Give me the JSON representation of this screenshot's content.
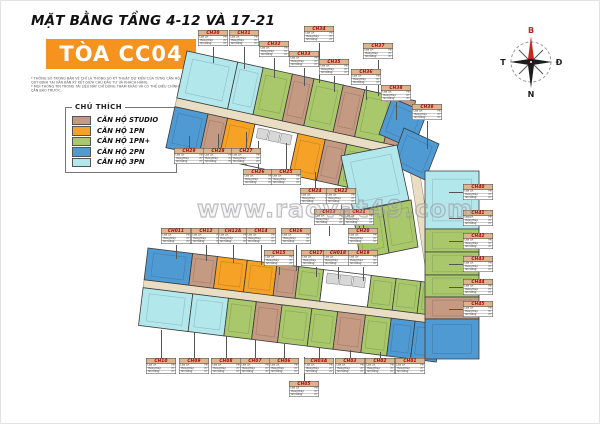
{
  "header": {
    "title": "MẶT BẰNG TẦNG 4-12 VÀ 17-21",
    "tower": "TÒA CC04",
    "disclaimer1": "* THÔNG SỐ TRONG BẢN VẼ CHỈ LÀ THÔNG SỐ KỸ THUẬT DỰ KIẾN CỦA TỪNG CĂN HỘ, SẼ ĐƯỢC QUY ĐỊNH TẠI VĂN BẢN KÝ KẾT GIỮA CHỦ ĐẦU TƯ VÀ KHÁCH HÀNG.",
    "disclaimer2": "* MỌI THÔNG TIN TRONG TÀI LIỆU NÀY CHỈ DÙNG THAM KHẢO VÀ CÓ THỂ ĐIỀU CHỈNH MÀ KHÔNG CẦN BÁO TRƯỚC."
  },
  "legend": {
    "title": "CHÚ THÍCH",
    "items": [
      {
        "label": "CĂN HỘ STUDIO",
        "type": "studio"
      },
      {
        "label": "CĂN HỘ 1PN",
        "type": "1pn"
      },
      {
        "label": "CĂN HỘ 1PN+",
        "type": "1pn+"
      },
      {
        "label": "CĂN HỘ 2PN",
        "type": "2pn"
      },
      {
        "label": "CĂN HỘ 3PN",
        "type": "3pn"
      }
    ]
  },
  "compass": {
    "north": "B",
    "south": "N",
    "east": "Đ",
    "west": "T"
  },
  "watermark": {
    "text": "www.raovat49.com"
  },
  "callout_rows": [
    {
      "k": "Loại CH:",
      "v": "PN"
    },
    {
      "k": "Thông thủy:",
      "v": "m²"
    },
    {
      "k": "Tim tường:",
      "v": "m²"
    }
  ],
  "colors": {
    "studio": "#c49a83",
    "1pn": "#f5a226",
    "1pn+": "#a9c86b",
    "2pn": "#4f9ad3",
    "3pn": "#b2e7ec",
    "corridor": "#e9dec4",
    "core": "#ffffff",
    "accent_orange": "#f6921e",
    "label_header": "#dcb48e",
    "unit_code_red": "#b40000"
  },
  "units": [
    {
      "id": "CH30",
      "type": "3pn"
    },
    {
      "id": "CH31",
      "type": "3pn"
    },
    {
      "id": "CH32",
      "type": "1pn+"
    },
    {
      "id": "CH33",
      "type": "studio"
    },
    {
      "id": "CH34",
      "type": "1pn+"
    },
    {
      "id": "CH35",
      "type": "studio"
    },
    {
      "id": "CH36",
      "type": "1pn+"
    },
    {
      "id": "CH37",
      "type": "studio"
    },
    {
      "id": "CH38",
      "type": "2pn"
    },
    {
      "id": "CH39",
      "type": "2pn"
    },
    {
      "id": "CH29",
      "type": "2pn"
    },
    {
      "id": "CH28",
      "type": "studio"
    },
    {
      "id": "CH27",
      "type": "1pn"
    },
    {
      "id": "CH26",
      "type": "1pn"
    },
    {
      "id": "CH25",
      "type": "studio"
    },
    {
      "id": "CH24",
      "type": "1pn+"
    },
    {
      "id": "CH23",
      "type": "1pn+"
    },
    {
      "id": "CH22",
      "type": "1pn+"
    },
    {
      "id": "CH21",
      "type": "1pn+"
    },
    {
      "id": "CH011",
      "type": "2pn"
    },
    {
      "id": "CH12",
      "type": "studio"
    },
    {
      "id": "CH12A",
      "type": "1pn"
    },
    {
      "id": "CH14",
      "type": "1pn"
    },
    {
      "id": "CH15",
      "type": "studio"
    },
    {
      "id": "CH16",
      "type": "1pn+"
    },
    {
      "id": "CH17",
      "type": "1pn+"
    },
    {
      "id": "CH018",
      "type": "1pn+"
    },
    {
      "id": "CH19",
      "type": "1pn+"
    },
    {
      "id": "CH20",
      "type": "3pn"
    },
    {
      "id": "CH40",
      "type": "3pn"
    },
    {
      "id": "CH41",
      "type": "1pn+"
    },
    {
      "id": "CH42",
      "type": "1pn+"
    },
    {
      "id": "CH43",
      "type": "1pn+"
    },
    {
      "id": "CH44",
      "type": "studio"
    },
    {
      "id": "CH45",
      "type": "2pn"
    },
    {
      "id": "CH10",
      "type": "3pn"
    },
    {
      "id": "CH09",
      "type": "3pn"
    },
    {
      "id": "CH08",
      "type": "1pn+"
    },
    {
      "id": "CH07",
      "type": "studio"
    },
    {
      "id": "CH06",
      "type": "1pn+"
    },
    {
      "id": "CH05",
      "type": "1pn+"
    },
    {
      "id": "CH03A",
      "type": "studio"
    },
    {
      "id": "CH03",
      "type": "1pn+"
    },
    {
      "id": "CH02",
      "type": "2pn"
    },
    {
      "id": "CH01",
      "type": "2pn"
    }
  ]
}
